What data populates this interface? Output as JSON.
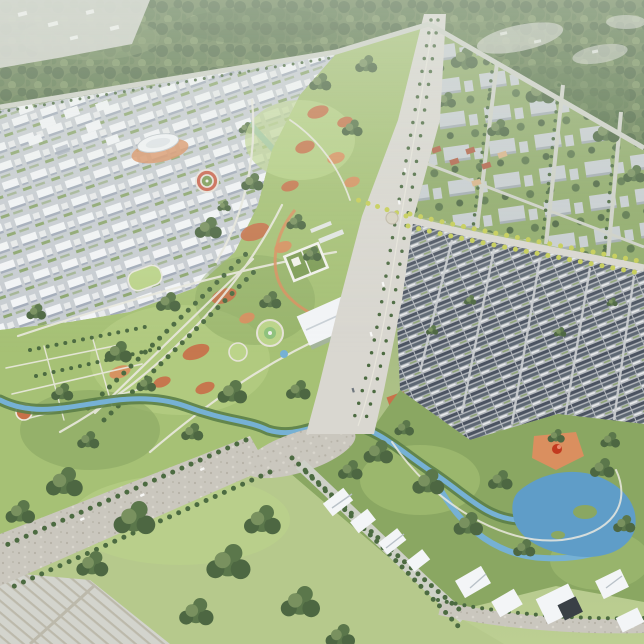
{
  "scene": {
    "title": "Aerial masterplan rendering of a new town and old town divided by a green park axis",
    "description": "Oblique bird's-eye 3D rendering of an urban masterplan: a new innovation district of white mid-rise blocks on the north-west, a large central park with lawns, terracotta courts, tree allees and winding paths, a grand tree-lined avenue running north-south, a campus district in greenery to the north-east, a dense historic old town of dark pitched roofs to the east below a yellow-tree boulevard, a wetland park with meandering river and lake to the south-east, white angular cultural buildings along the southern road, meadows and woods to the south-west, and a forest belt across the north. A wide arterial highway crosses the south-west corner.",
    "view": "oblique aerial",
    "regions": [
      {
        "id": "forest-belt",
        "label": "northern forest belt"
      },
      {
        "id": "innovation-district",
        "label": "new town of white mid-rise blocks"
      },
      {
        "id": "central-park",
        "label": "central park green axis"
      },
      {
        "id": "campus-district",
        "label": "campus blocks in greenery"
      },
      {
        "id": "old-town",
        "label": "dense historic old town"
      },
      {
        "id": "wetland-park",
        "label": "wetland river park"
      },
      {
        "id": "cultural-quarter",
        "label": "white angular cultural buildings"
      },
      {
        "id": "south-meadows",
        "label": "meadows and woodland"
      }
    ],
    "landmarks": [
      {
        "id": "main-avenue",
        "label": "grand north-south avenue with tree medians"
      },
      {
        "id": "yellow-boulevard",
        "label": "boulevard lined with yellow autumn trees"
      },
      {
        "id": "highway",
        "label": "wide south-west arterial"
      },
      {
        "id": "oval-pavilion",
        "label": "white oval-roof pavilion"
      },
      {
        "id": "circular-plaza",
        "label": "circular plaza with red ring"
      },
      {
        "id": "white-hall",
        "label": "white exhibition hall beside the avenue"
      },
      {
        "id": "walled-garden",
        "label": "white-walled courtyard garden"
      },
      {
        "id": "red-sculpture-plaza",
        "label": "terracotta plaza with red sculpture"
      },
      {
        "id": "lake",
        "label": "wetland lake"
      },
      {
        "id": "stream",
        "label": "park stream crossing under the avenue"
      }
    ],
    "palette": {
      "groundTop": "#93a973",
      "groundBottom": "#bccf92",
      "forestBase": "#677f52",
      "forestDark": "#4d6742",
      "forestMid": "#5b774b",
      "forestLight": "#79915f",
      "parkLawn": "#a6c175",
      "parkLawnLight": "#bcd48a",
      "parkLawnDark": "#8aa762",
      "fieldGreen": "#b6c98c",
      "cityGround": "#c8cdd2",
      "buildingWhite": "#f3f5f7",
      "buildingShadow": "#a2abb9",
      "campusGround": "#90ab6a",
      "campusBlock": "#c8ced1",
      "campusBlockShadow": "#a4adb2",
      "oldtownGround": "#b6babf",
      "roofDark": "#4b5361",
      "roofMid": "#5d6773",
      "wallWhite": "#e9ebec",
      "courtGreen": "#7d9c55",
      "road": "#d9d7d0",
      "highway": "#cac7be",
      "minorRoad": "#ced1c7",
      "pathCol": "#eae9df",
      "water": "#76b1d4",
      "lake": "#5f9dc8",
      "terracotta": "#c8714a",
      "terracottaLight": "#da8f5f",
      "yellowTree": "#c6ce55",
      "yellowTreeLight": "#e0db6e",
      "hedge": "#4c6b41",
      "bank": "#5c8048",
      "redAccent": "#c2391f",
      "darkBox": "#3a4046",
      "paleQuarry": "#d3d4cd",
      "redRoof": "#b26248",
      "tanRoof": "#d9b489"
    }
  }
}
